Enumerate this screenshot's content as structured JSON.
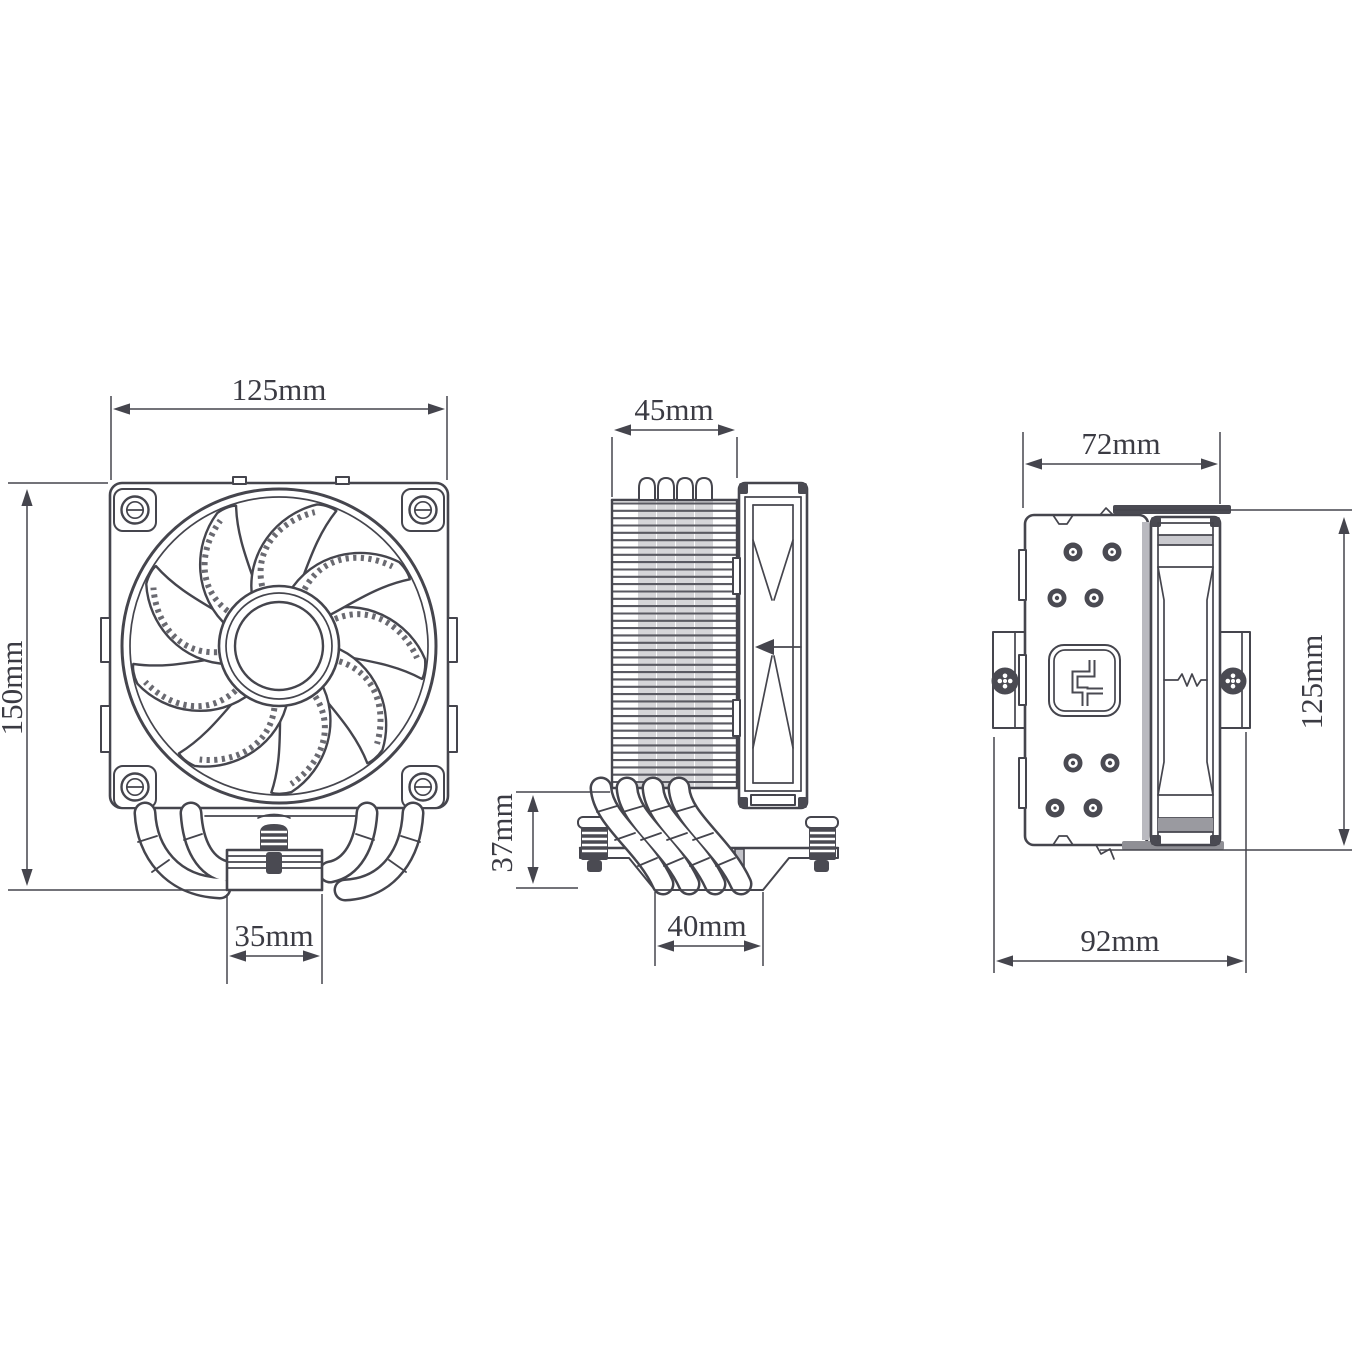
{
  "drawing": {
    "title": "CPU air cooler dimensional drawing (front, side and rear views)",
    "views": {
      "front": {
        "width": "125mm",
        "height": "150mm",
        "base_width": "35mm"
      },
      "side": {
        "fin_depth": "45mm",
        "base_height": "37mm",
        "base_width": "40mm"
      },
      "rear": {
        "width": "72mm",
        "fan_height": "125mm",
        "bracket_span": "92mm"
      }
    },
    "colors": {
      "line": "#45454d",
      "text": "#3b3b43",
      "shade_light": "#c2c2c8",
      "shade_dark": "#8f8f95",
      "background": "#ffffff"
    }
  }
}
